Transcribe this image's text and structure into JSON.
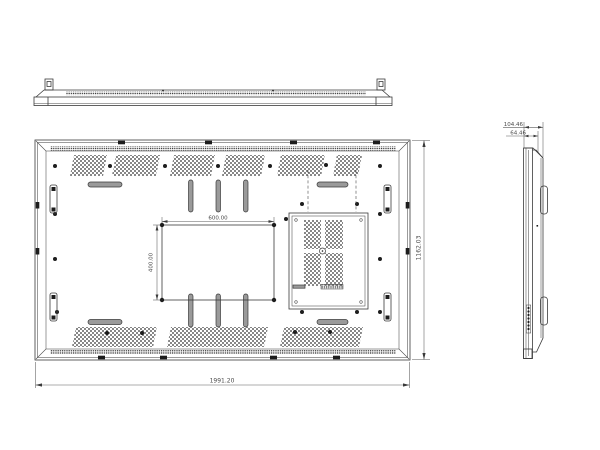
{
  "drawing": {
    "subject": "flat-panel-display-technical-drawing",
    "ink_color": "#3a3a3a",
    "slot_fill": "#9a9a9a",
    "views": {
      "rear_view": {
        "overall_width": "1991.20",
        "overall_height": "1162.03",
        "vesa_width": "600.00",
        "vesa_height": "400.00"
      },
      "side_view": {
        "depth_total": "104.46",
        "depth_body": "64.46"
      }
    }
  }
}
